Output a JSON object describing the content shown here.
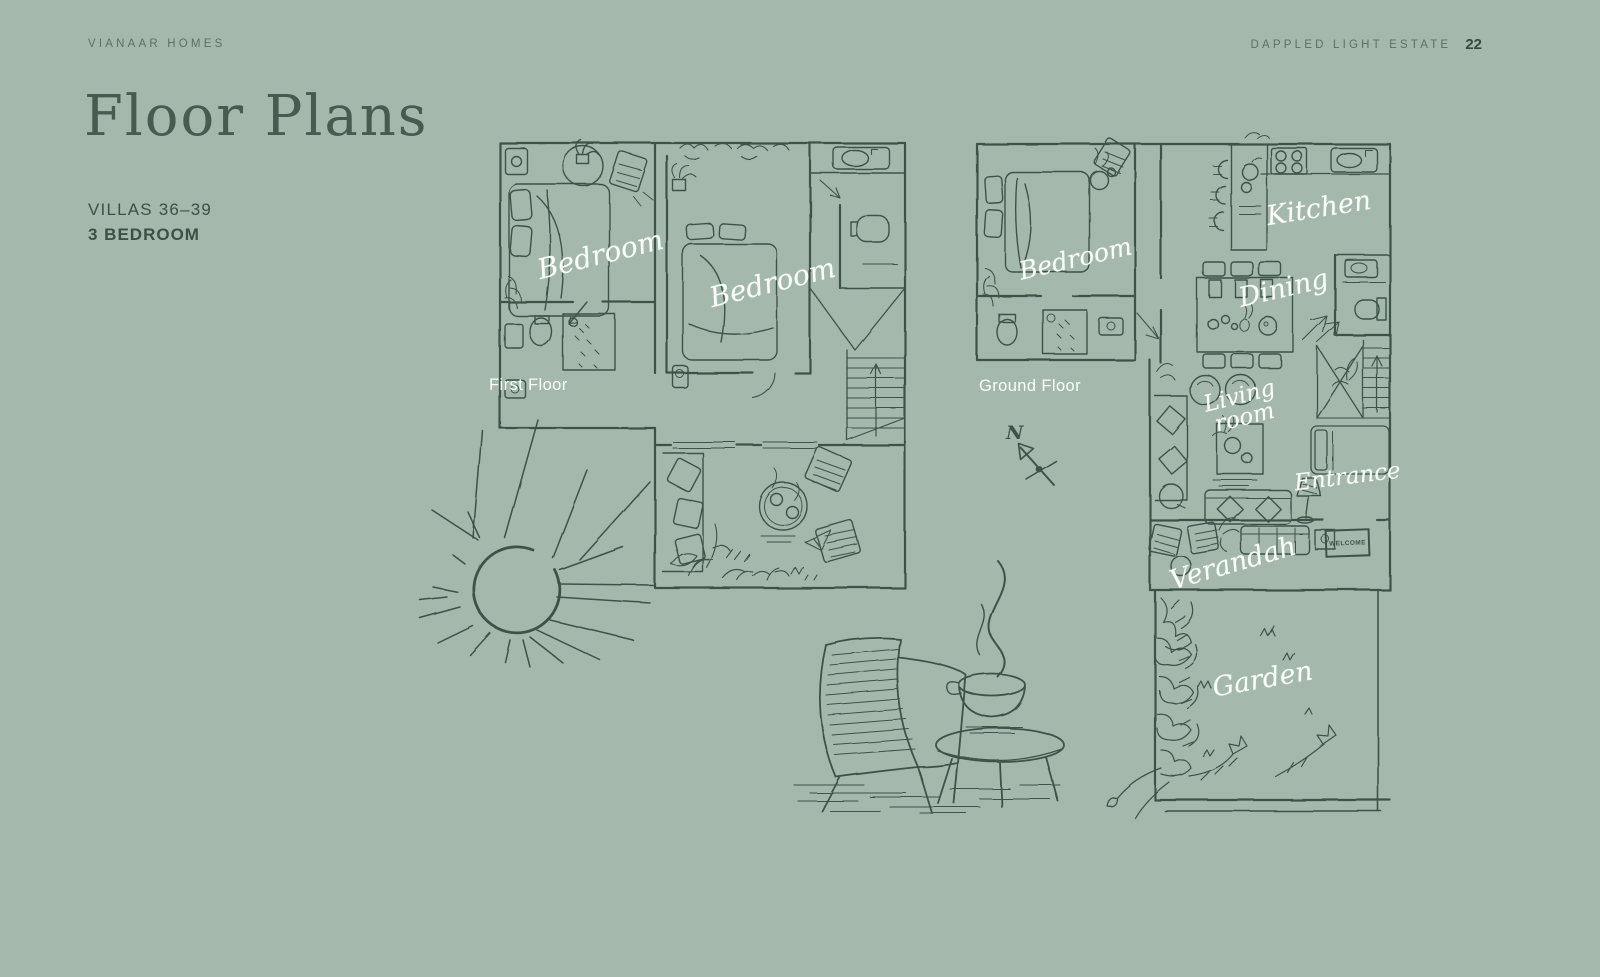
{
  "header": {
    "brand": "VIANAAR HOMES",
    "estate": "DAPPLED LIGHT ESTATE",
    "page_number": "22"
  },
  "title": "Floor Plans",
  "subtitle": {
    "villas": "VILLAS 36–39",
    "bedrooms": "3 BEDROOM"
  },
  "first_floor": {
    "label": "First Floor",
    "room_labels": {
      "bedroom1": "Bedroom",
      "bedroom2": "Bedroom"
    }
  },
  "ground_floor": {
    "label": "Ground Floor",
    "room_labels": {
      "bedroom": "Bedroom",
      "kitchen": "Kitchen",
      "dining": "Dining",
      "living_line1": "Living",
      "living_line2": "room",
      "entrance": "Entrance",
      "verandah": "Verandah",
      "garden": "Garden"
    },
    "doormat": "WELCOME"
  },
  "compass": {
    "north": "N"
  },
  "colors": {
    "background": "#a4b9ac",
    "ink": "#3e5348",
    "header_text": "#5d7065",
    "label_text": "#fbfdfb"
  }
}
